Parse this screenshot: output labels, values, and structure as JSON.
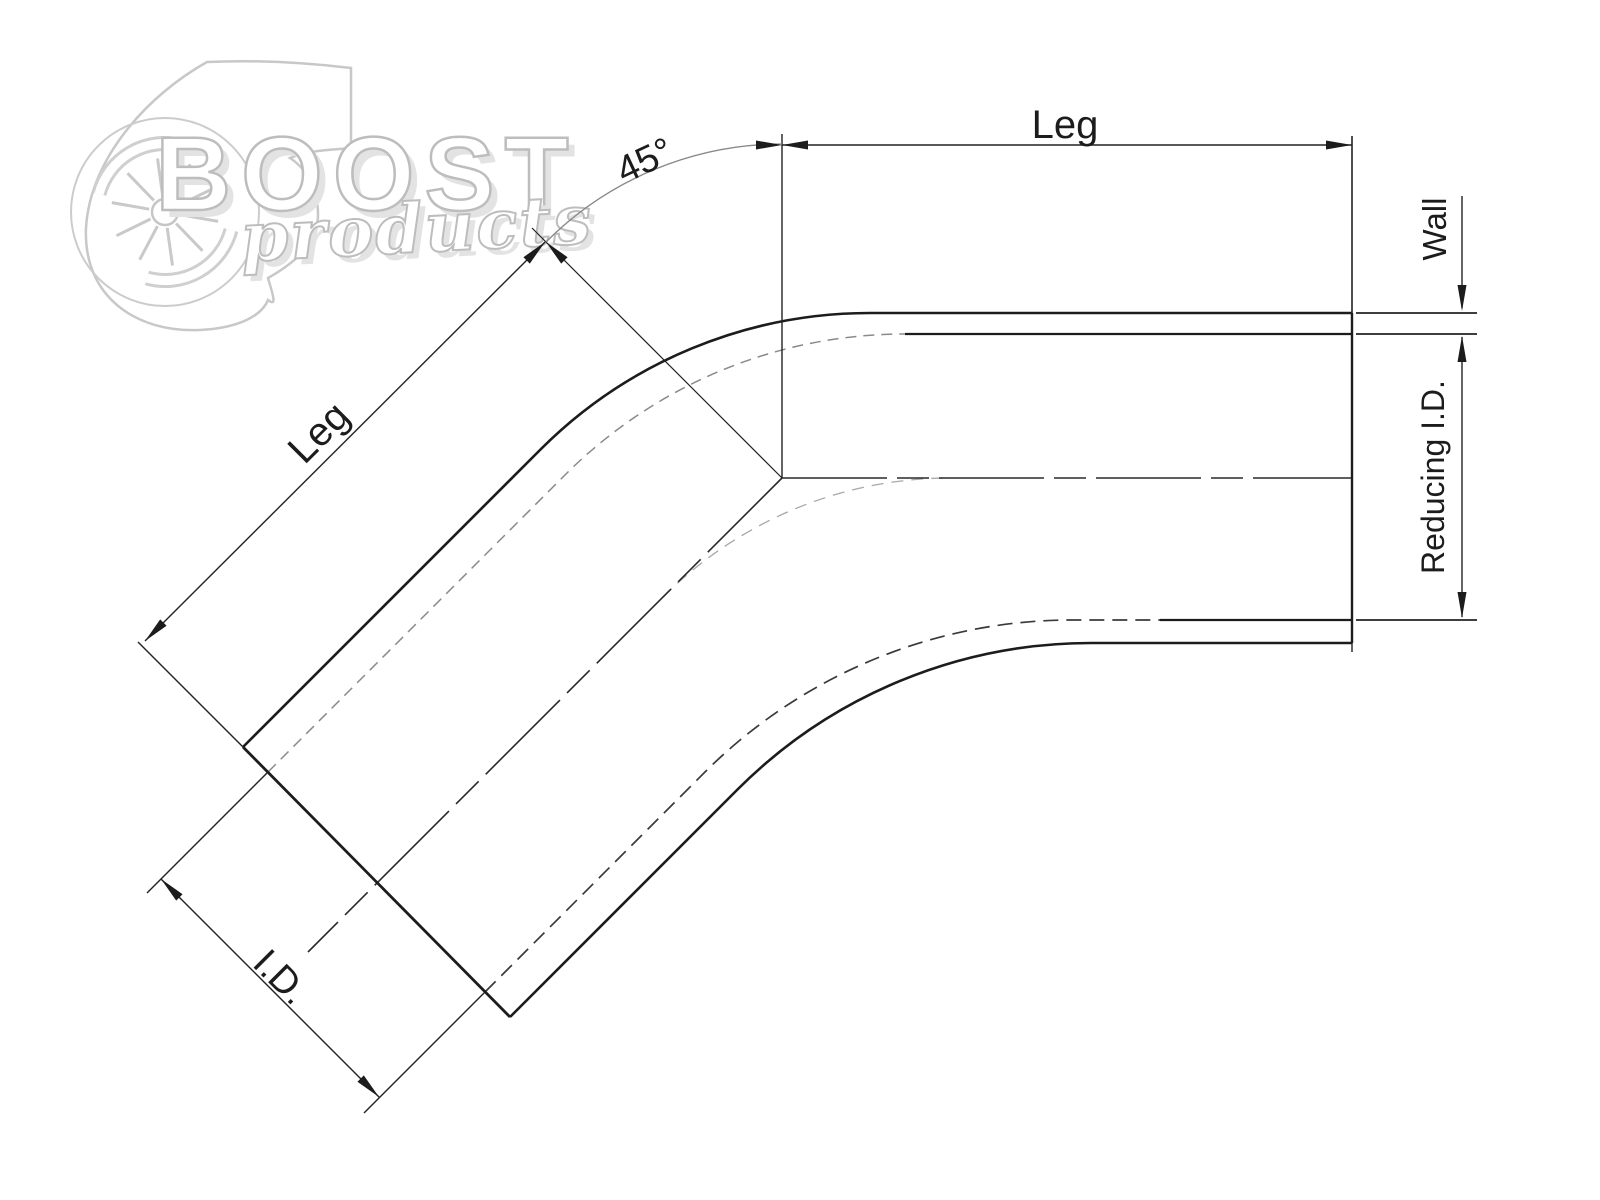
{
  "page": {
    "background_color": "#ffffff"
  },
  "watermark": {
    "brand": "BOOST",
    "brand_sub": "products",
    "icon": "turbocharger-icon",
    "color": "#c6c6c6"
  },
  "drawing": {
    "type": "technical-dimension-diagram-45-degree-reducing-elbow",
    "labels": {
      "leg_top": "Leg",
      "leg_diagonal": "Leg",
      "bend_angle": "45°",
      "wall": "Wall",
      "reducing_inner_diameter": "Reducing I.D.",
      "inner_diameter": "I.D."
    },
    "colors": {
      "object_line": "#1c1c1c",
      "hidden_line": "#8a8a8a",
      "dimension_line": "#222222",
      "angle_arc": "#888888",
      "centerline": "#2a2a2a"
    }
  }
}
